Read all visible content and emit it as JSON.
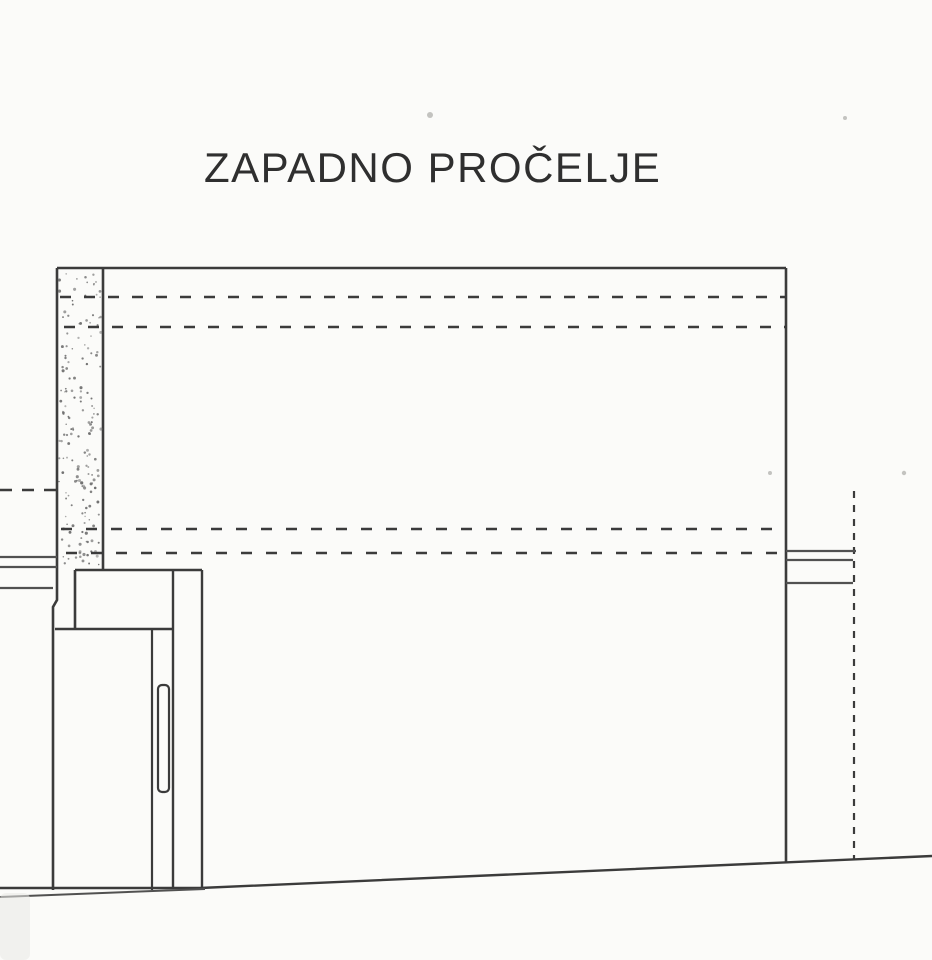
{
  "document": {
    "title": "ZAPADNO PROČELJE"
  },
  "colors": {
    "paper": "#fbfbf9",
    "ink": "#3b3b3b",
    "ink_light": "#515151",
    "stipple": "#6f6f6f",
    "speck": "#c3c3c0",
    "smudge": "#e9e9e5"
  },
  "drawing": {
    "width": 932,
    "height": 960,
    "elements": [
      {
        "name": "facade-top-edge",
        "type": "line",
        "x1": 57,
        "y1": 268,
        "x2": 786,
        "y2": 268,
        "w": 2.6,
        "color": "ink"
      },
      {
        "name": "facade-right-edge",
        "type": "line",
        "x1": 786,
        "y1": 268,
        "x2": 786,
        "y2": 863,
        "w": 2.6,
        "color": "ink"
      },
      {
        "name": "wall-column-right-edge",
        "type": "line",
        "x1": 103,
        "y1": 268,
        "x2": 103,
        "y2": 570,
        "w": 2.6,
        "color": "ink"
      },
      {
        "name": "wall-column-left-edge",
        "type": "polyline",
        "points": [
          [
            57,
            268
          ],
          [
            57,
            600
          ],
          [
            53,
            607
          ],
          [
            53,
            890
          ]
        ],
        "w": 2.6,
        "color": "ink"
      },
      {
        "name": "wall-column-stipple",
        "type": "stipple",
        "x": 59,
        "y": 273,
        "w": 42,
        "h": 292,
        "count": 175,
        "r": 1.15,
        "seed": 7,
        "color": "stipple"
      },
      {
        "name": "roof-level-dashed-line-1",
        "type": "line",
        "x1": 60,
        "y1": 297,
        "x2": 786,
        "y2": 297,
        "w": 2.6,
        "dash": "11 13",
        "color": "ink"
      },
      {
        "name": "roof-level-dashed-line-2",
        "type": "line",
        "x1": 64,
        "y1": 327,
        "x2": 786,
        "y2": 327,
        "w": 2.6,
        "dash": "11 13",
        "color": "ink"
      },
      {
        "name": "floor-level-dashed-line-1",
        "type": "line",
        "x1": 61,
        "y1": 529,
        "x2": 786,
        "y2": 529,
        "w": 2.6,
        "dash": "11 14",
        "color": "ink"
      },
      {
        "name": "floor-level-dashed-line-2",
        "type": "line",
        "x1": 66,
        "y1": 553,
        "x2": 786,
        "y2": 553,
        "w": 2.6,
        "dash": "11 14",
        "color": "ink"
      },
      {
        "name": "left-dashed-level-line",
        "type": "line",
        "x1": 0,
        "y1": 490,
        "x2": 56,
        "y2": 490,
        "w": 2.6,
        "dash": "12 10",
        "color": "ink"
      },
      {
        "name": "right-dashed-boundary-line",
        "type": "line",
        "x1": 854,
        "y1": 491,
        "x2": 854,
        "y2": 859,
        "w": 2.2,
        "dash": "7 7",
        "color": "ink"
      },
      {
        "name": "left-wall-cap-top",
        "type": "line",
        "x1": 0,
        "y1": 557,
        "x2": 57,
        "y2": 557,
        "w": 2.2,
        "color": "ink_light"
      },
      {
        "name": "left-wall-cap-bottom",
        "type": "line",
        "x1": 0,
        "y1": 567,
        "x2": 57,
        "y2": 567,
        "w": 2.2,
        "color": "ink_light"
      },
      {
        "name": "left-wall-band-bottom",
        "type": "line",
        "x1": 0,
        "y1": 588,
        "x2": 53,
        "y2": 588,
        "w": 2.2,
        "color": "ink_light"
      },
      {
        "name": "right-wall-cap-top",
        "type": "line",
        "x1": 786,
        "y1": 551,
        "x2": 856,
        "y2": 551,
        "w": 2.2,
        "color": "ink_light"
      },
      {
        "name": "right-wall-cap-bottom",
        "type": "line",
        "x1": 786,
        "y1": 560,
        "x2": 853,
        "y2": 560,
        "w": 2.2,
        "color": "ink_light"
      },
      {
        "name": "right-wall-band-bottom",
        "type": "line",
        "x1": 786,
        "y1": 583,
        "x2": 853,
        "y2": 583,
        "w": 2.2,
        "color": "ink_light"
      },
      {
        "name": "canopy-top-edge",
        "type": "line",
        "x1": 75,
        "y1": 570,
        "x2": 202,
        "y2": 570,
        "w": 2.6,
        "color": "ink"
      },
      {
        "name": "canopy-left-edge",
        "type": "line",
        "x1": 75,
        "y1": 570,
        "x2": 75,
        "y2": 629,
        "w": 2.6,
        "color": "ink"
      },
      {
        "name": "canopy-bottom-edge",
        "type": "line",
        "x1": 55,
        "y1": 629,
        "x2": 173,
        "y2": 629,
        "w": 2.6,
        "color": "ink"
      },
      {
        "name": "door-leaf-right-edge",
        "type": "line",
        "x1": 152,
        "y1": 629,
        "x2": 152,
        "y2": 890,
        "w": 2.2,
        "color": "ink"
      },
      {
        "name": "door-pillar-left-edge",
        "type": "line",
        "x1": 173,
        "y1": 570,
        "x2": 173,
        "y2": 889,
        "w": 2.4,
        "color": "ink"
      },
      {
        "name": "door-pillar-right-edge",
        "type": "line",
        "x1": 202,
        "y1": 570,
        "x2": 202,
        "y2": 888,
        "w": 2.4,
        "color": "ink"
      },
      {
        "name": "door-handle",
        "type": "rect",
        "x": 158,
        "y": 685,
        "w": 11,
        "h": 107,
        "rx": 4,
        "sw": 2.2,
        "color": "ink"
      },
      {
        "name": "ground-line",
        "type": "polyline",
        "points": [
          [
            0,
            888
          ],
          [
            200,
            888
          ],
          [
            932,
            856
          ]
        ],
        "w": 2.4,
        "color": "ink"
      },
      {
        "name": "ground-terrain-line",
        "type": "line",
        "x1": 0,
        "y1": 897,
        "x2": 205,
        "y2": 889,
        "w": 2.0,
        "color": "ink_light"
      },
      {
        "name": "scan-smudge",
        "type": "rect",
        "x": 0,
        "y": 893,
        "w": 30,
        "h": 67,
        "rx": 6,
        "sw": 0,
        "fill": "smudge",
        "opacity": 0.55
      },
      {
        "name": "scan-speck-1",
        "type": "dot",
        "x": 430,
        "y": 115,
        "r": 3,
        "color": "speck"
      },
      {
        "name": "scan-speck-2",
        "type": "dot",
        "x": 845,
        "y": 118,
        "r": 2,
        "color": "speck"
      },
      {
        "name": "scan-speck-3",
        "type": "dot",
        "x": 770,
        "y": 473,
        "r": 2,
        "color": "speck"
      },
      {
        "name": "scan-speck-4",
        "type": "dot",
        "x": 904,
        "y": 473,
        "r": 2.2,
        "color": "speck"
      }
    ]
  }
}
